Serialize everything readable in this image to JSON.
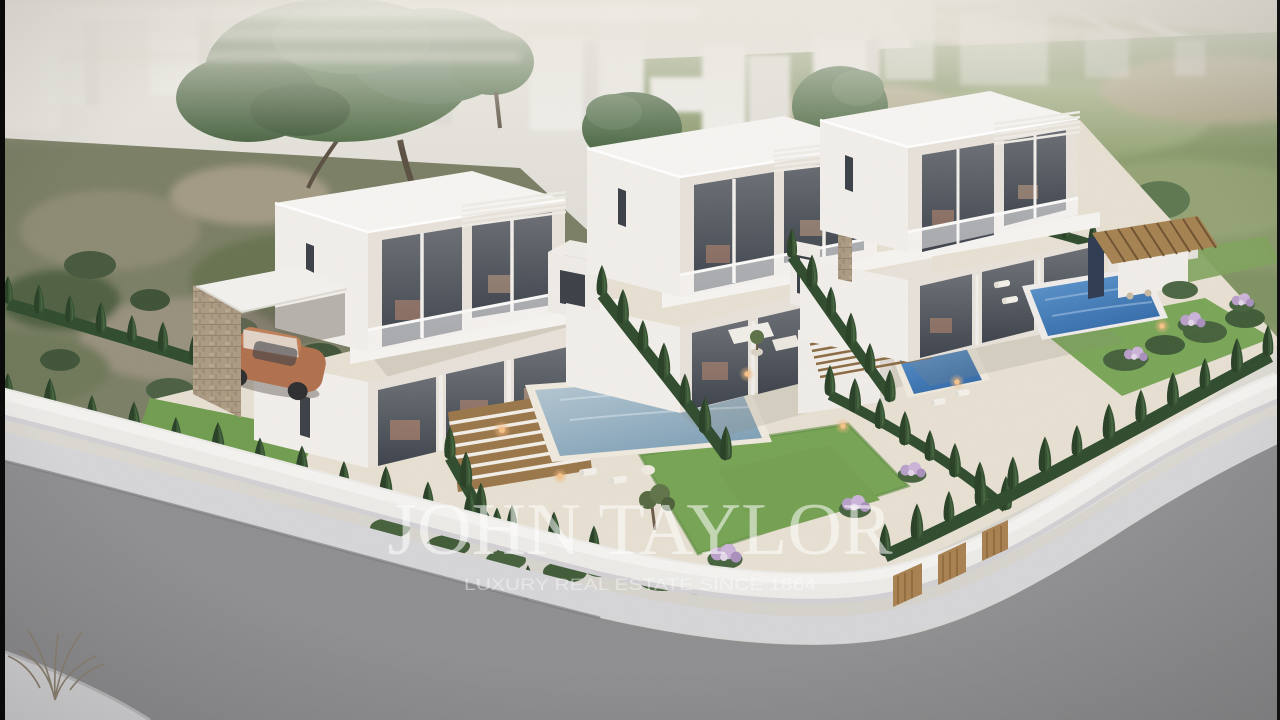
{
  "meta": {
    "type": "3d-aerial-architectural-rendering",
    "subject": "Development of three modern two-storey white villas with private pools, cypress-lined gardens and a curved perimeter road",
    "villa_count": 3
  },
  "watermark": {
    "brand": "JOHN TAYLOR",
    "tagline": "LUXURY REAL ESTATE SINCE 1864"
  },
  "style": {
    "vars": {
      "brand-opacity": "0.55",
      "tagline-opacity": "0.42",
      "road": "#8e8e90",
      "sidewalk": "#d6d5d7",
      "wall": "#ecebe8",
      "wall-shade": "#d2d0d3",
      "villa-lit": "#f2efeb",
      "villa-shade": "#e7e1d9",
      "roof": "#f7f5f2",
      "glass-dark": "#41464e",
      "glow": "#c98e6f",
      "pool-steel": "#93afc2",
      "pool-blue": "#3f7cba",
      "cypress": "#33502f",
      "bush": "#45603b",
      "lawn": "#75a152",
      "field": "#8a9a6c",
      "scrub": "#7a7e63",
      "wood": "#9a7648",
      "stone": "#b09f88",
      "navy": "#2d3950",
      "flower": "#b89fc9",
      "car": "#b06f4b",
      "haze": "#e5e1d9",
      "edge-bar": "#0a0a0a"
    }
  }
}
